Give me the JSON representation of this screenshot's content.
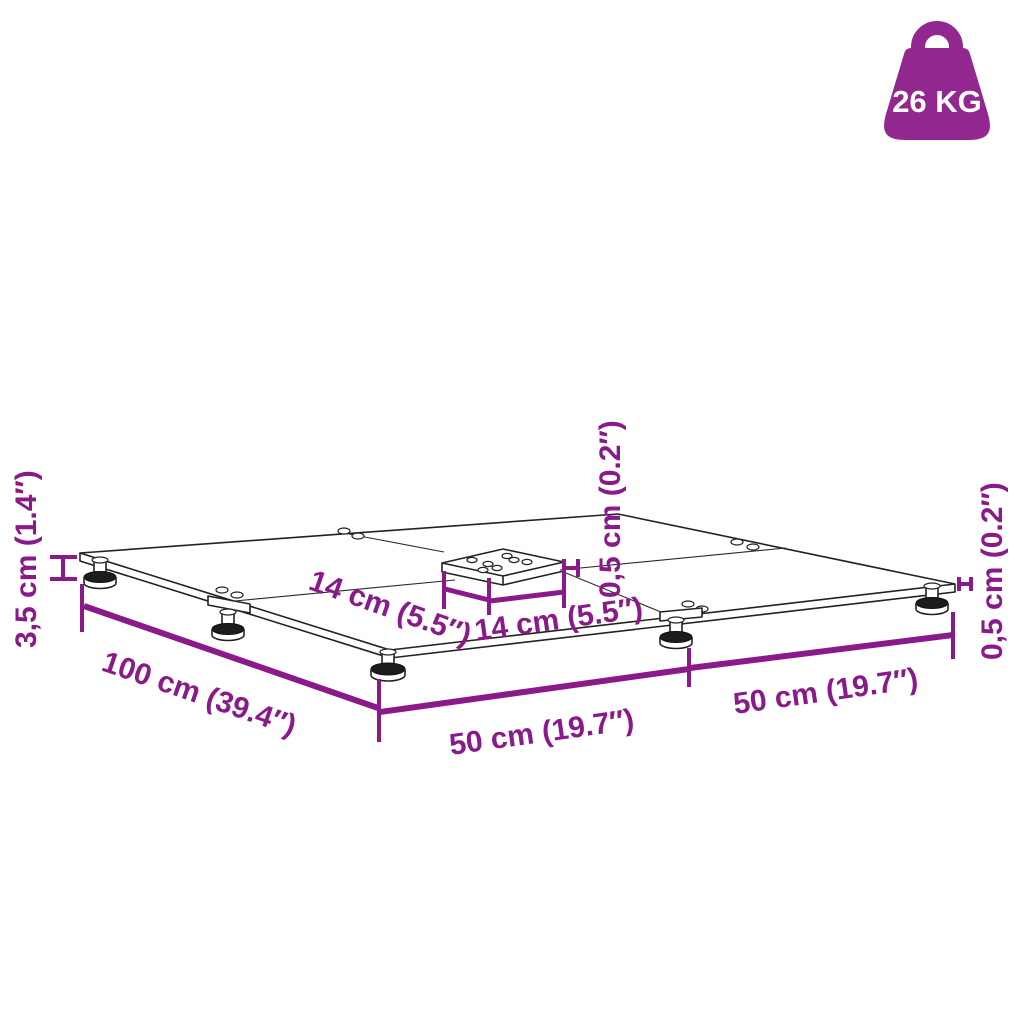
{
  "figure": {
    "weight_badge": {
      "label": "26 KG",
      "color": "#92278F"
    },
    "labels": {
      "height": "3,5 cm (1.4″)",
      "total_width": "100 cm (39.4″)",
      "front_left_half": "50 cm (19.7″)",
      "front_right_half": "50 cm (19.7″)",
      "mount_plate_side_left": "14 cm (5.5″)",
      "mount_plate_side_right": "14 cm (5.5″)",
      "plate_thickness_center": "0,5 cm (0.2″)",
      "plate_thickness_right": "0,5 cm (0.2″)"
    },
    "colors": {
      "dimension": "#8A1A8A",
      "badge": "#92278F",
      "line_art": "#222222",
      "background": "#ffffff"
    }
  }
}
